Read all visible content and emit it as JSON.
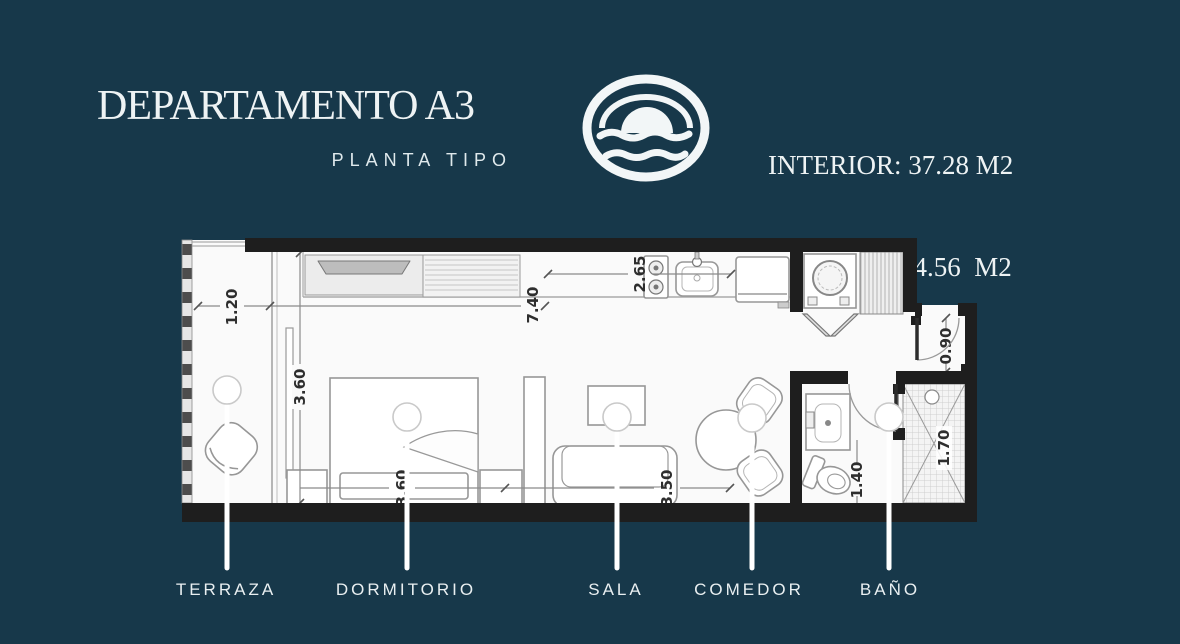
{
  "header": {
    "title": "DEPARTAMENTO A3",
    "subtitle": "PLANTA TIPO",
    "stats": [
      "INTERIOR: 37.28 M2",
      "TERRAZA:  4.56  M2",
      "TOTAL: 41.84 M2"
    ]
  },
  "logo": {
    "name": "sunset-over-waves-emblem"
  },
  "plan": {
    "dims": {
      "terrace_width": "1.20",
      "interior_length": "7.40",
      "kitchen_length": "2.65",
      "room_depth": "3.60",
      "bedroom_width": "3.60",
      "sala_width": "3.50",
      "entry_door": "0.90",
      "bath_width": "1.40",
      "shower_length": "1.70"
    },
    "rooms": [
      {
        "id": "terraza",
        "label": "TERRAZA"
      },
      {
        "id": "dormitorio",
        "label": "DORMITORIO"
      },
      {
        "id": "sala",
        "label": "SALA"
      },
      {
        "id": "comedor",
        "label": "COMEDOR"
      },
      {
        "id": "bano",
        "label": "BAÑO"
      }
    ]
  },
  "colors": {
    "background": "#17384a",
    "text": "#eef3f4",
    "wall": "#1e1e1e",
    "floor": "#fafafa",
    "line": "#979797"
  }
}
